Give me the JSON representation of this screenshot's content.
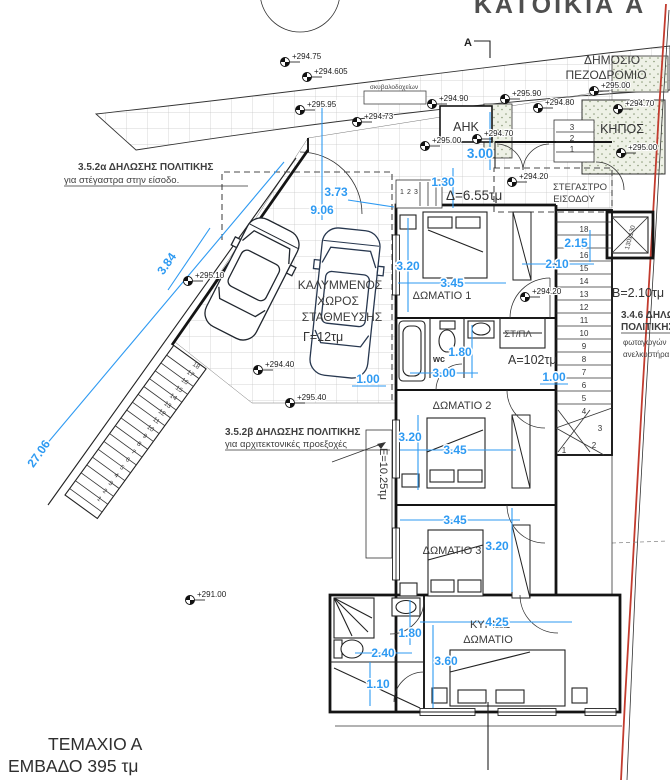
{
  "colors": {
    "dimension": "#2e9af2",
    "boundary_red": "#c23b2e"
  },
  "title": "ΚΑΤΟΙΚΙΑ Α",
  "parcel": {
    "name": "ΤΕΜΑΧΙΟ Α",
    "area": "ΕΜΒΑΔΟ 395 τμ"
  },
  "labels": {
    "sidewalk_line1": "ΔΗΜΟΣΙΟ",
    "sidewalk_line2": "ΠΕΖΟΔΡΟΜΙΟ",
    "bins": "σκυβαλοδοχείων",
    "ahk": "ΑΗΚ",
    "garden": "ΚΗΠΟΣ",
    "canopy_line1": "ΣΤΕΓΑΣΤΡΟ",
    "canopy_line2": "ΕΙΣΟΔΟΥ",
    "parking_line1": "ΚΑΛΥΜΜΕΝΟΣ",
    "parking_line2": "ΧΩΡΟΣ",
    "parking_line3": "ΣΤΑΘΜΕΥΣΗΣ",
    "parking_area": "Γ=12τμ",
    "room1": "ΔΩΜΑΤΙΟ 1",
    "room2": "ΔΩΜΑΤΙΟ 2",
    "room3": "ΔΩΜΑΤΙΟ 3",
    "master_line1": "ΚΥΡΙΩΣ",
    "master_line2": "ΔΩΜΑΤΙΟ",
    "wc": "wc",
    "laundry": "ΣΤ/ΠΛ",
    "area_a": "Α=102τμ",
    "area_b": "Β=2.10τμ",
    "area_d": "Δ=6.55τμ",
    "area_e": "Ε=10.25τμ",
    "lift": "130x130",
    "section_mark": "A"
  },
  "notes": {
    "n1_title": "3.5.2α ΔΗΛΩΣΗΣ ΠΟΛΙΤΙΚΗΣ",
    "n1_body": "για στέγαστρα στην είσοδο.",
    "n2_title": "3.5.2β ΔΗΛΩΣΗΣ ΠΟΛΙΤΙΚΗΣ",
    "n2_body": "για αρχιτεκτονικές προεξοχές",
    "n3_line1": "3.4.6 ΔΗΛΩ",
    "n3_line2": "ΠΟΛΙΤΙΚΗΣ",
    "n3_line3": "φωταγωγών",
    "n3_line4": "ανελκυστήρα"
  },
  "dimensions": {
    "plot": "27.06",
    "plot2": "3.84",
    "d373": "3.73",
    "d906": "9.06",
    "d130": "1.30",
    "d300_entry": "3.00",
    "r1_w": "3.20",
    "r1_l": "3.45",
    "d215": "2.15",
    "d210": "2.10",
    "wc_w": "1.80",
    "wc_l": "3.00",
    "d100_hall": "1.00",
    "d100_park": "1.00",
    "r2_w": "3.20",
    "r2_l": "3.45",
    "r23": "3.45",
    "r3_w": "3.20",
    "m_l": "4.25",
    "m_180": "1.80",
    "m_240": "2.40",
    "m_360": "3.60",
    "m_110": "1.10"
  },
  "levels": {
    "l1": "+294.75",
    "l2": "+294.605",
    "l3": "+295.95",
    "l4": "+294.73",
    "l5": "+294.90",
    "l6": "+295.90",
    "l7": "+294.80",
    "l8": "+295.00",
    "l9": "+294.70",
    "l10": "+295.00",
    "l11": "+294.70",
    "l12": "+295.00",
    "l13": "+294.20",
    "l14": "+295.10",
    "l15": "+294.40",
    "l16": "+295.40",
    "l17": "+294.20",
    "l18": "+291.00"
  },
  "stairs": {
    "left_steps": [
      "1",
      "2",
      "3",
      "4",
      "5",
      "6",
      "7",
      "8",
      "9",
      "10",
      "11",
      "12",
      "13",
      "14",
      "15",
      "16",
      "17",
      "18"
    ],
    "main_steps": [
      "1",
      "2",
      "3",
      "4",
      "5",
      "6",
      "7",
      "8",
      "9",
      "10",
      "11",
      "12",
      "13",
      "14",
      "15",
      "16",
      "17",
      "18"
    ],
    "entry_steps": [
      "1",
      "2",
      "3"
    ],
    "garden_steps": [
      "3",
      "2",
      "1"
    ]
  }
}
